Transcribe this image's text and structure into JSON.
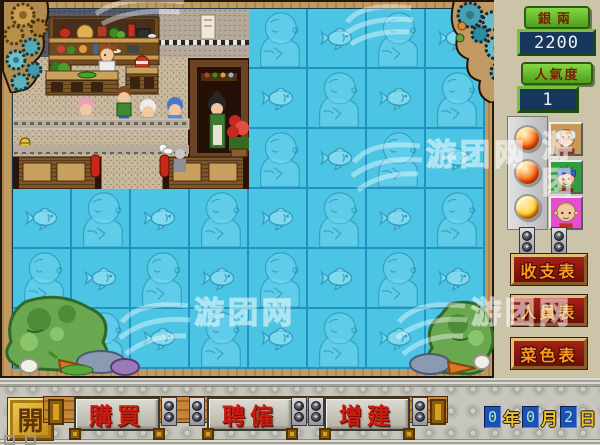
{
  "app": {
    "watermark_text": "游团网",
    "watermark_text_short": "游团"
  },
  "hud": {
    "money": {
      "label": "銀兩",
      "value": "2200"
    },
    "popularity": {
      "label": "人氣度",
      "value": "1"
    },
    "staff": [
      {
        "id": "staff-1",
        "led_color": "#ff6a10",
        "portrait": "old-chef",
        "portrait_bg": "#c89858"
      },
      {
        "id": "staff-2",
        "led_color": "#ff6a10",
        "portrait": "blue-hair-kid",
        "portrait_bg": "#2f9e40"
      },
      {
        "id": "staff-3",
        "led_color": "#ffd22a",
        "portrait": "bald-kid",
        "portrait_bg": "#e34fd0"
      }
    ],
    "reports": [
      {
        "label": "收支表"
      },
      {
        "label": "人員表"
      },
      {
        "label": "菜色表"
      }
    ]
  },
  "actions": {
    "system_button": "開",
    "buttons": [
      {
        "label": "購買"
      },
      {
        "label": "聘僱"
      },
      {
        "label": "增建"
      }
    ]
  },
  "date": {
    "year": "0",
    "year_unit": "年",
    "month": "0",
    "month_unit": "月",
    "day": "2",
    "day_unit": "日"
  },
  "map": {
    "cols": 8,
    "rows": 6,
    "tile_w": 59,
    "tile_h": 60,
    "restaurant_cols": 4,
    "restaurant_rows": 3,
    "water_sprites": {
      "even": "baby",
      "odd": "fish"
    },
    "tile_color": "#4cc5e4",
    "grid_line_color": "#2193c2"
  }
}
